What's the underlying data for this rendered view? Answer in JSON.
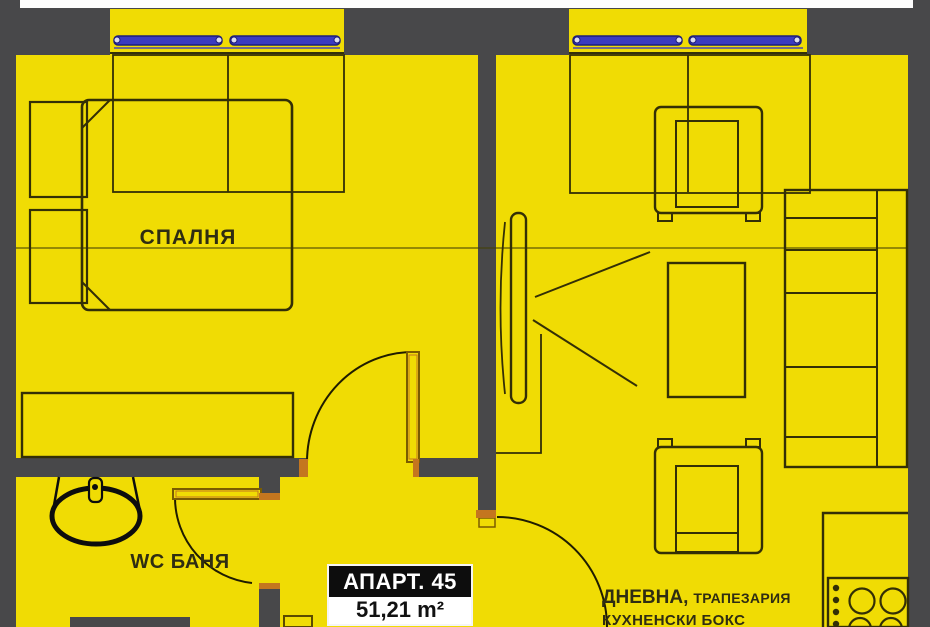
{
  "app": {
    "type": "architectural-floor-plan",
    "description": "Yellow apartment floor plan, apartment 45"
  },
  "palette": {
    "floor_yellow": "#f0dc04",
    "wall_gray": "#48484a",
    "window_blue": "#3b3bc0",
    "door_orange": "#c4761f",
    "line_dark": "#332f06",
    "badge_black": "#0d0d0d",
    "white": "#fdfdfd"
  },
  "rooms": [
    {
      "id": "bedroom",
      "label": "СПАЛНЯ"
    },
    {
      "id": "wc_bath",
      "label": "WC БАНЯ"
    },
    {
      "id": "living",
      "label_primary": "ДНЕВНА,",
      "label_secondary": "ТРАПЕЗАРИЯ",
      "label_line2": "КУХНЕНСКИ БОКС"
    }
  ],
  "apartment_badge": {
    "number_label": "АПАРТ. 45",
    "area_label": "51,21 m²"
  },
  "fixtures": {
    "icons": [
      "bed-icon",
      "nightstand-icon",
      "wardrobe-icon",
      "toilet-icon",
      "armchair-icon",
      "coffee-table-icon",
      "tv-icon",
      "sofa-icon",
      "stove-icon",
      "window-icon",
      "door-arc-icon",
      "kitchen-counter-icon"
    ]
  }
}
